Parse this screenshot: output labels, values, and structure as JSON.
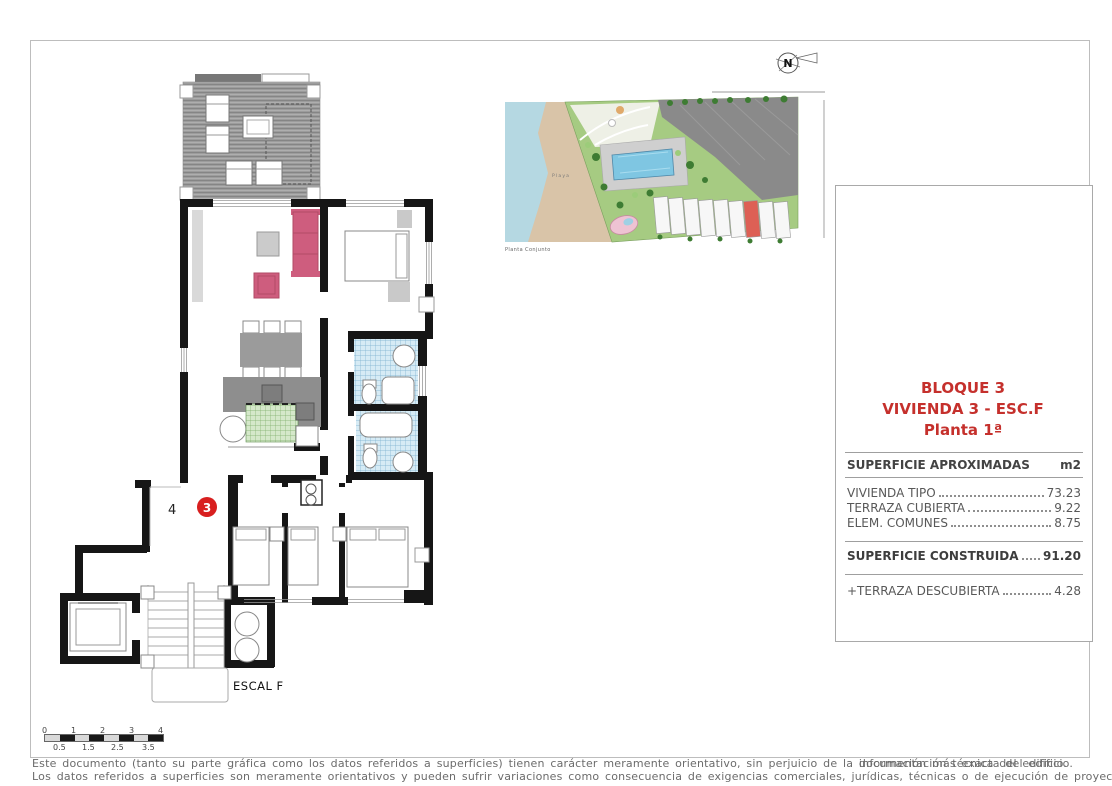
{
  "plan": {
    "hall_number": "4",
    "unit_number": "3",
    "stair_label": "ESCAL F",
    "scale_bar": {
      "top": [
        "0",
        "1",
        "2",
        "3",
        "4"
      ],
      "bottom": [
        "0.5",
        "1.5",
        "2.5",
        "3.5"
      ]
    }
  },
  "site_plan": {
    "caption": "Planta Conjunto",
    "beach_label": "Playa",
    "north_label": "N"
  },
  "panel": {
    "title": {
      "line1": "BLOQUE 3",
      "line2": "VIVIENDA 3 - ESC.F",
      "line3": "Planta 1ª"
    },
    "table": {
      "header_label": "SUPERFICIE APROXIMADAS",
      "header_unit": "m2",
      "rows": [
        {
          "label": "VIVIENDA TIPO",
          "value": "73.23"
        },
        {
          "label": "TERRAZA CUBIERTA",
          "value": "9.22"
        },
        {
          "label": "ELEM. COMUNES",
          "value": "8.75"
        }
      ],
      "total": {
        "label": "SUPERFICIE CONSTRUIDA",
        "value": "91.20"
      },
      "extra": {
        "label": "+TERRAZA DESCUBIERTA",
        "value": "4.28"
      }
    }
  },
  "disclaimer": {
    "line1_prefix": "Este documento (tanto su parte gráfica como los datos referidos a superficies) tienen carácter meramente orientativo, sin perjuicio de la ",
    "line1_overlap_a": "documentación técnica del edificio.",
    "line1_overlap_b": "información más exacta del edificio.",
    "line2": "Los datos referidos a superficies son meramente orientativos y pueden sufrir variaciones como consecuencia de exigencias comerciales, jurídicas, técnicas o de ejecución de proyecto."
  },
  "colors": {
    "accent_red": "#c5302c",
    "marker_red": "#d81f1f",
    "sofa_pink": "#ce5d7e",
    "tile_blue": "#d6ebf5",
    "tile_green": "#d5e8ca",
    "deck_gray": "#9c9c9c",
    "wall_black": "#161616"
  }
}
